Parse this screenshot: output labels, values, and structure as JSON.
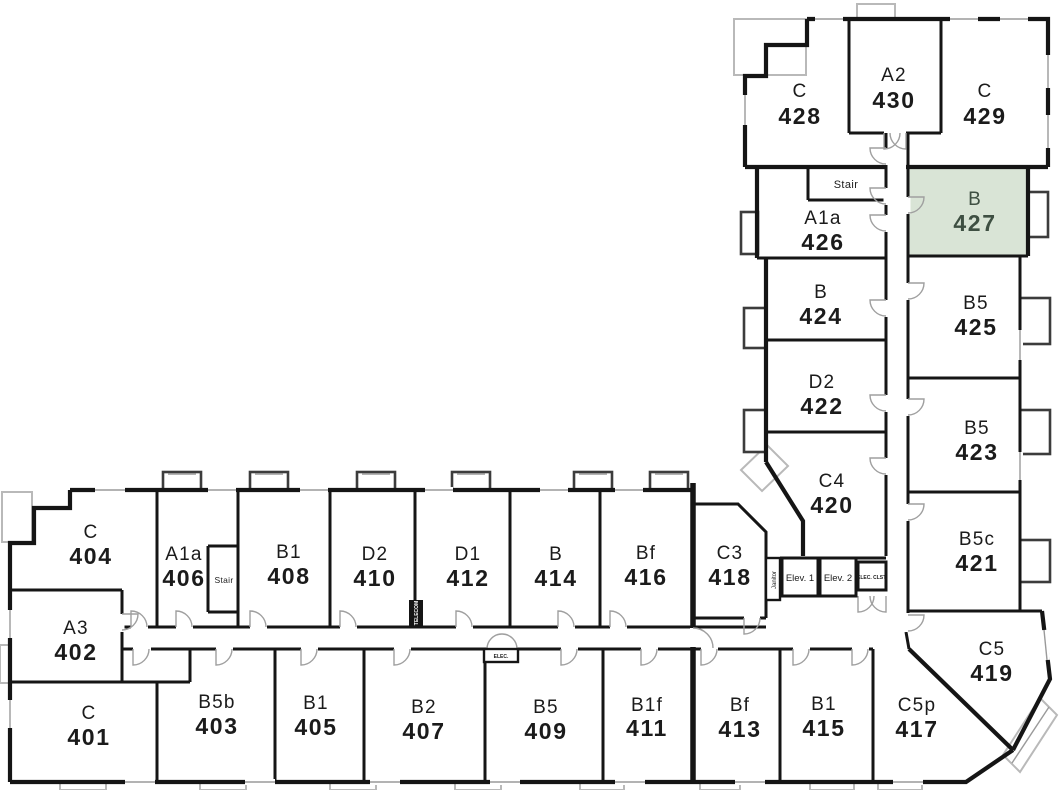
{
  "selected_unit": {
    "type": "B",
    "number": "427",
    "fill_color": "#d9e4d6",
    "text_color": "#3e4f42"
  },
  "wall_color": "#151515",
  "rooms": [
    {
      "type": "C",
      "number": "428"
    },
    {
      "type": "A2",
      "number": "430"
    },
    {
      "type": "C",
      "number": "429"
    },
    {
      "type": "A1a",
      "number": "426"
    },
    {
      "type": "B",
      "number": "427",
      "highlighted": true
    },
    {
      "type": "B",
      "number": "424"
    },
    {
      "type": "B5",
      "number": "425"
    },
    {
      "type": "D2",
      "number": "422"
    },
    {
      "type": "B5",
      "number": "423"
    },
    {
      "type": "C4",
      "number": "420"
    },
    {
      "type": "B5c",
      "number": "421"
    },
    {
      "type": "C5",
      "number": "419"
    },
    {
      "type": "C",
      "number": "404"
    },
    {
      "type": "A1a",
      "number": "406"
    },
    {
      "type": "B1",
      "number": "408"
    },
    {
      "type": "D2",
      "number": "410"
    },
    {
      "type": "D1",
      "number": "412"
    },
    {
      "type": "B",
      "number": "414"
    },
    {
      "type": "Bf",
      "number": "416"
    },
    {
      "type": "C3",
      "number": "418"
    },
    {
      "type": "A3",
      "number": "402"
    },
    {
      "type": "C",
      "number": "401"
    },
    {
      "type": "B5b",
      "number": "403"
    },
    {
      "type": "B1",
      "number": "405"
    },
    {
      "type": "B2",
      "number": "407"
    },
    {
      "type": "B5",
      "number": "409"
    },
    {
      "type": "B1f",
      "number": "411"
    },
    {
      "type": "Bf",
      "number": "413"
    },
    {
      "type": "B1",
      "number": "415"
    },
    {
      "type": "C5p",
      "number": "417"
    }
  ],
  "labels": {
    "stair_upper": "Stair",
    "stair_lower": "Stair",
    "elevator_1": "Elev. 1",
    "elevator_2": "Elev. 2",
    "electrical_closet": "ELEC. CLST.",
    "electrical": "ELEC.",
    "janitor": "Janitor",
    "telecom": "TELECOM"
  }
}
